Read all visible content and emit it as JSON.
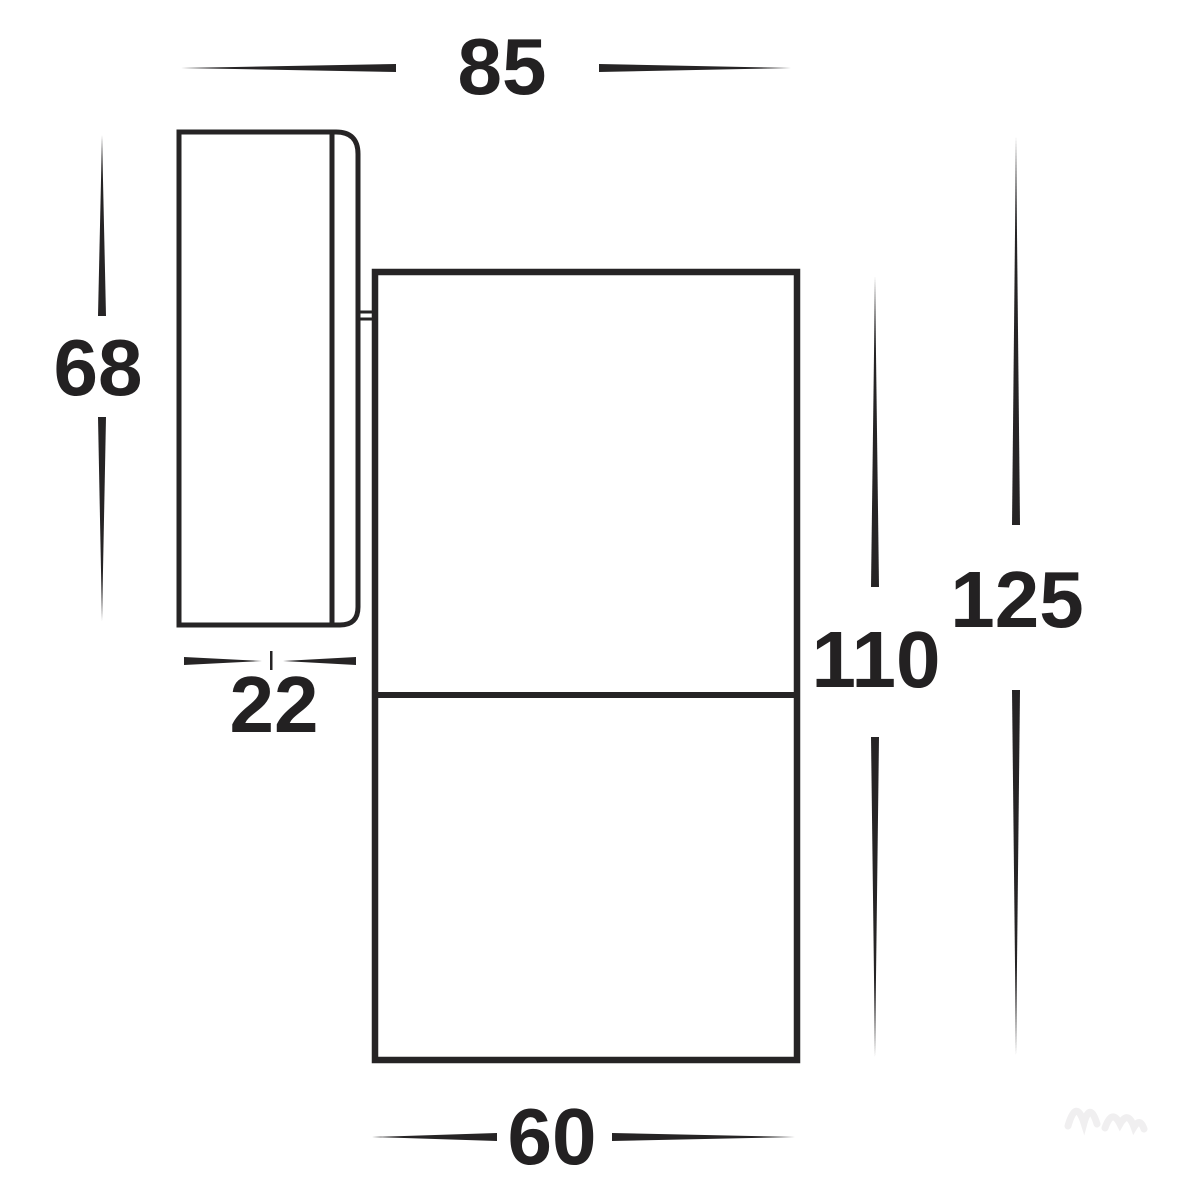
{
  "diagram": {
    "kind": "technical-dimension-drawing",
    "subject": "wall-mounted-spot-light-side-view",
    "line_color": "#262425",
    "text_color": "#232122",
    "background_color": "#ffffff",
    "dimensions": {
      "overall_depth_top": {
        "label": "85"
      },
      "plate_height_left": {
        "label": "68"
      },
      "plate_depth": {
        "label": "22"
      },
      "body_height": {
        "label": "110"
      },
      "overall_height": {
        "label": "125"
      },
      "body_width_bottom": {
        "label": "60"
      }
    }
  }
}
